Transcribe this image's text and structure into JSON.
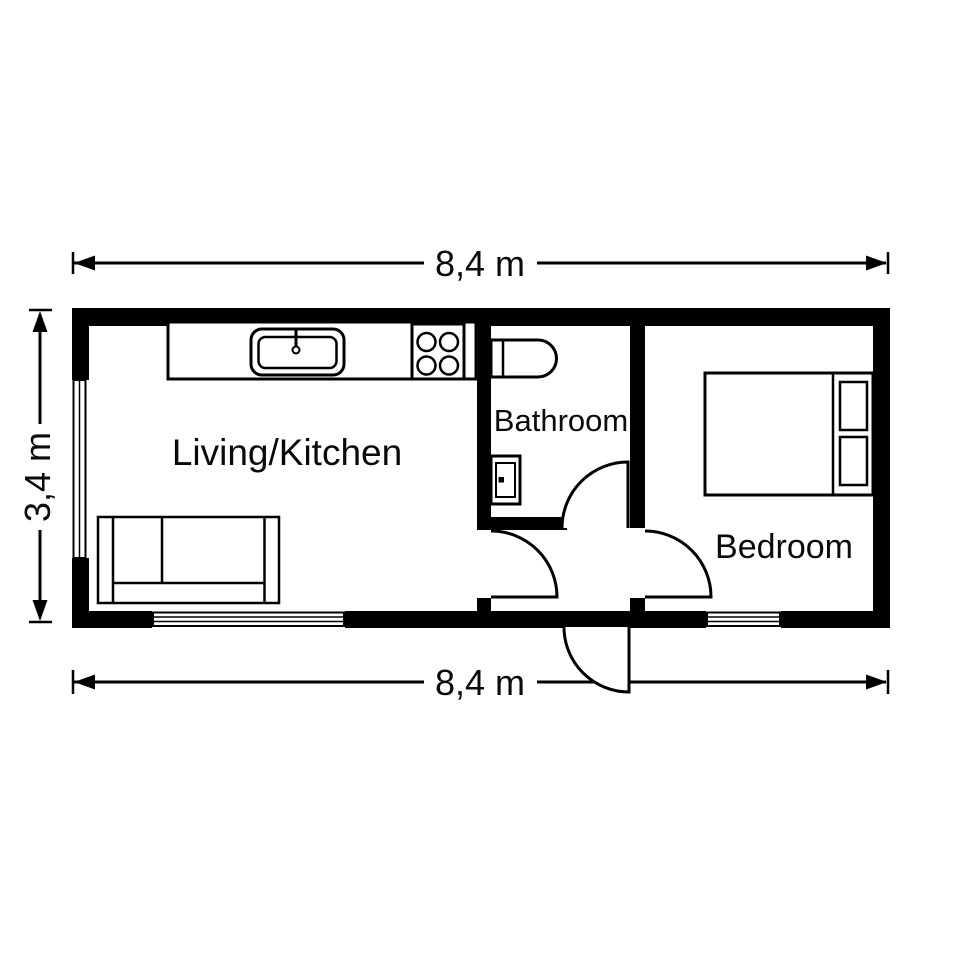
{
  "dimensions": {
    "top": "8,4 m",
    "bottom": "8,4 m",
    "left": "3,4 m"
  },
  "rooms": {
    "living_kitchen": "Living/Kitchen",
    "bathroom": "Bathroom",
    "bedroom": "Bedroom"
  },
  "fixtures": {
    "kitchen": [
      "counter",
      "sink-with-faucet",
      "stove-4-burner"
    ],
    "living": [
      "sofa-two-seat"
    ],
    "bathroom": [
      "toilet",
      "washbasin"
    ],
    "bedroom": [
      "double-bed",
      "pillow",
      "pillow"
    ],
    "windows": [
      "left-wall-window",
      "bottom-living-window",
      "bottom-bedroom-window"
    ],
    "doors": [
      "living-room-door",
      "bathroom-door",
      "bedroom-door",
      "entrance-door"
    ]
  },
  "colors": {
    "wall": "#000000",
    "line": "#000000",
    "background": "#ffffff",
    "text": "#0a0a0a"
  }
}
